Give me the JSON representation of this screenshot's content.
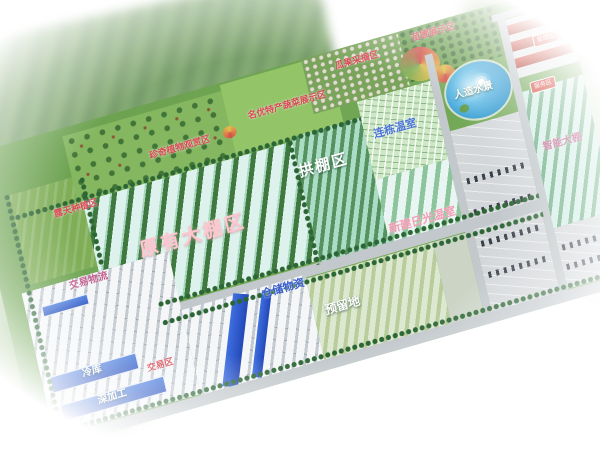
{
  "zones": {
    "nursery_display": {
      "label": "苗圃展示区"
    },
    "fruit_picking": {
      "label": "瓜果采摘区"
    },
    "vegetable_display": {
      "label": "名优特产蔬菜展示区"
    },
    "rare_plants": {
      "label": "珍奇植物观赏区"
    },
    "open_field": {
      "label": "露天种植区"
    },
    "water_feature": {
      "label": "人造水景"
    },
    "multi_span_greenhouse": {
      "label": "连栋温室"
    },
    "arch_shed": {
      "label": "拱棚区"
    },
    "existing_greenhouse": {
      "label": "原有大棚区"
    },
    "new_solar_greenhouse": {
      "label": "新建日光温室"
    },
    "smart_greenhouse": {
      "label": "智能大棚"
    },
    "storage_materials": {
      "label": "仓储物资"
    },
    "trade_logistics": {
      "label": "交易物流"
    },
    "reserved_land": {
      "label": "预留地"
    },
    "cold_storage": {
      "label": "冷库"
    },
    "deep_processing": {
      "label": "深加工"
    },
    "trading_area": {
      "label": "交易区"
    },
    "management_badge": {
      "label": "管理区"
    },
    "service_badge": {
      "label": "服务区"
    }
  },
  "colors": {
    "label_red": "#d94a56",
    "label_blue": "#3a5fd0",
    "label_pink": "#f29cb4",
    "label_white": "#ffffff",
    "pond_blue": "#2e97cf",
    "roof_blue": "#2851c0",
    "roof_red": "#c8473a",
    "field_green": "#6fa253"
  }
}
